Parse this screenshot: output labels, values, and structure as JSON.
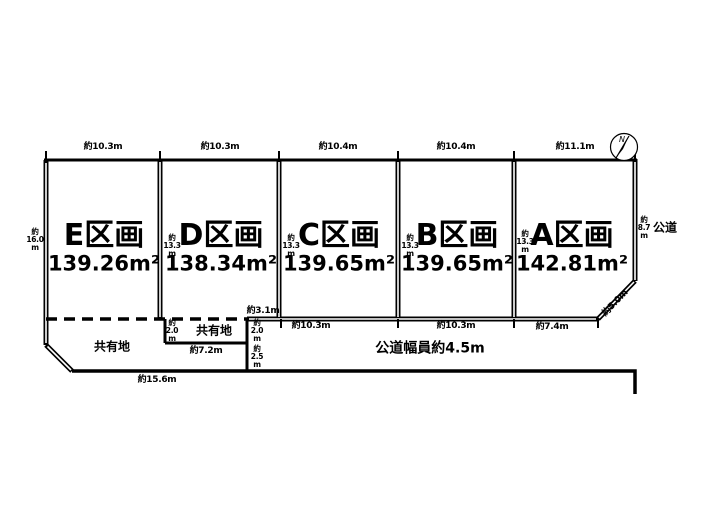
{
  "compass": {
    "north": "N"
  },
  "plots": [
    {
      "id": "E",
      "name": "E区画",
      "area": "139.26m²",
      "top_dim": "約10.3m",
      "side_dim": "約\n16.0\nm"
    },
    {
      "id": "D",
      "name": "D区画",
      "area": "138.34m²",
      "top_dim": "約10.3m",
      "side_dim": "約\n13.3\nm",
      "bottom_dim": "約3.1m"
    },
    {
      "id": "C",
      "name": "C区画",
      "area": "139.65m²",
      "top_dim": "約10.4m",
      "side_dim": "約\n13.3\nm",
      "bottom_dim": "約10.3m"
    },
    {
      "id": "B",
      "name": "B区画",
      "area": "139.65m²",
      "top_dim": "約10.4m",
      "side_dim": "約\n13.3\nm",
      "bottom_dim": "約10.3m"
    },
    {
      "id": "A",
      "name": "A区画",
      "area": "142.81m²",
      "top_dim": "約11.1m",
      "side_dim": "約\n13.3\nm",
      "bottom_dim": "約7.4m",
      "right_dim": "約\n8.7\nm",
      "corner_dim": "約5.0m"
    }
  ],
  "shared_land": {
    "left_label": "共有地",
    "box_label": "共有地",
    "box_left_dim": "約\n2.0\nm",
    "box_right_dim": "約\n2.0\nm",
    "box_bottom_dim": "約7.2m",
    "right_lower_dim": "約\n2.5\nm",
    "bottom_dim": "約15.6m"
  },
  "road": {
    "east_label": "公道",
    "width_label": "公道幅員約4.5m"
  },
  "colors": {
    "line": "#000000",
    "background": "#ffffff"
  }
}
